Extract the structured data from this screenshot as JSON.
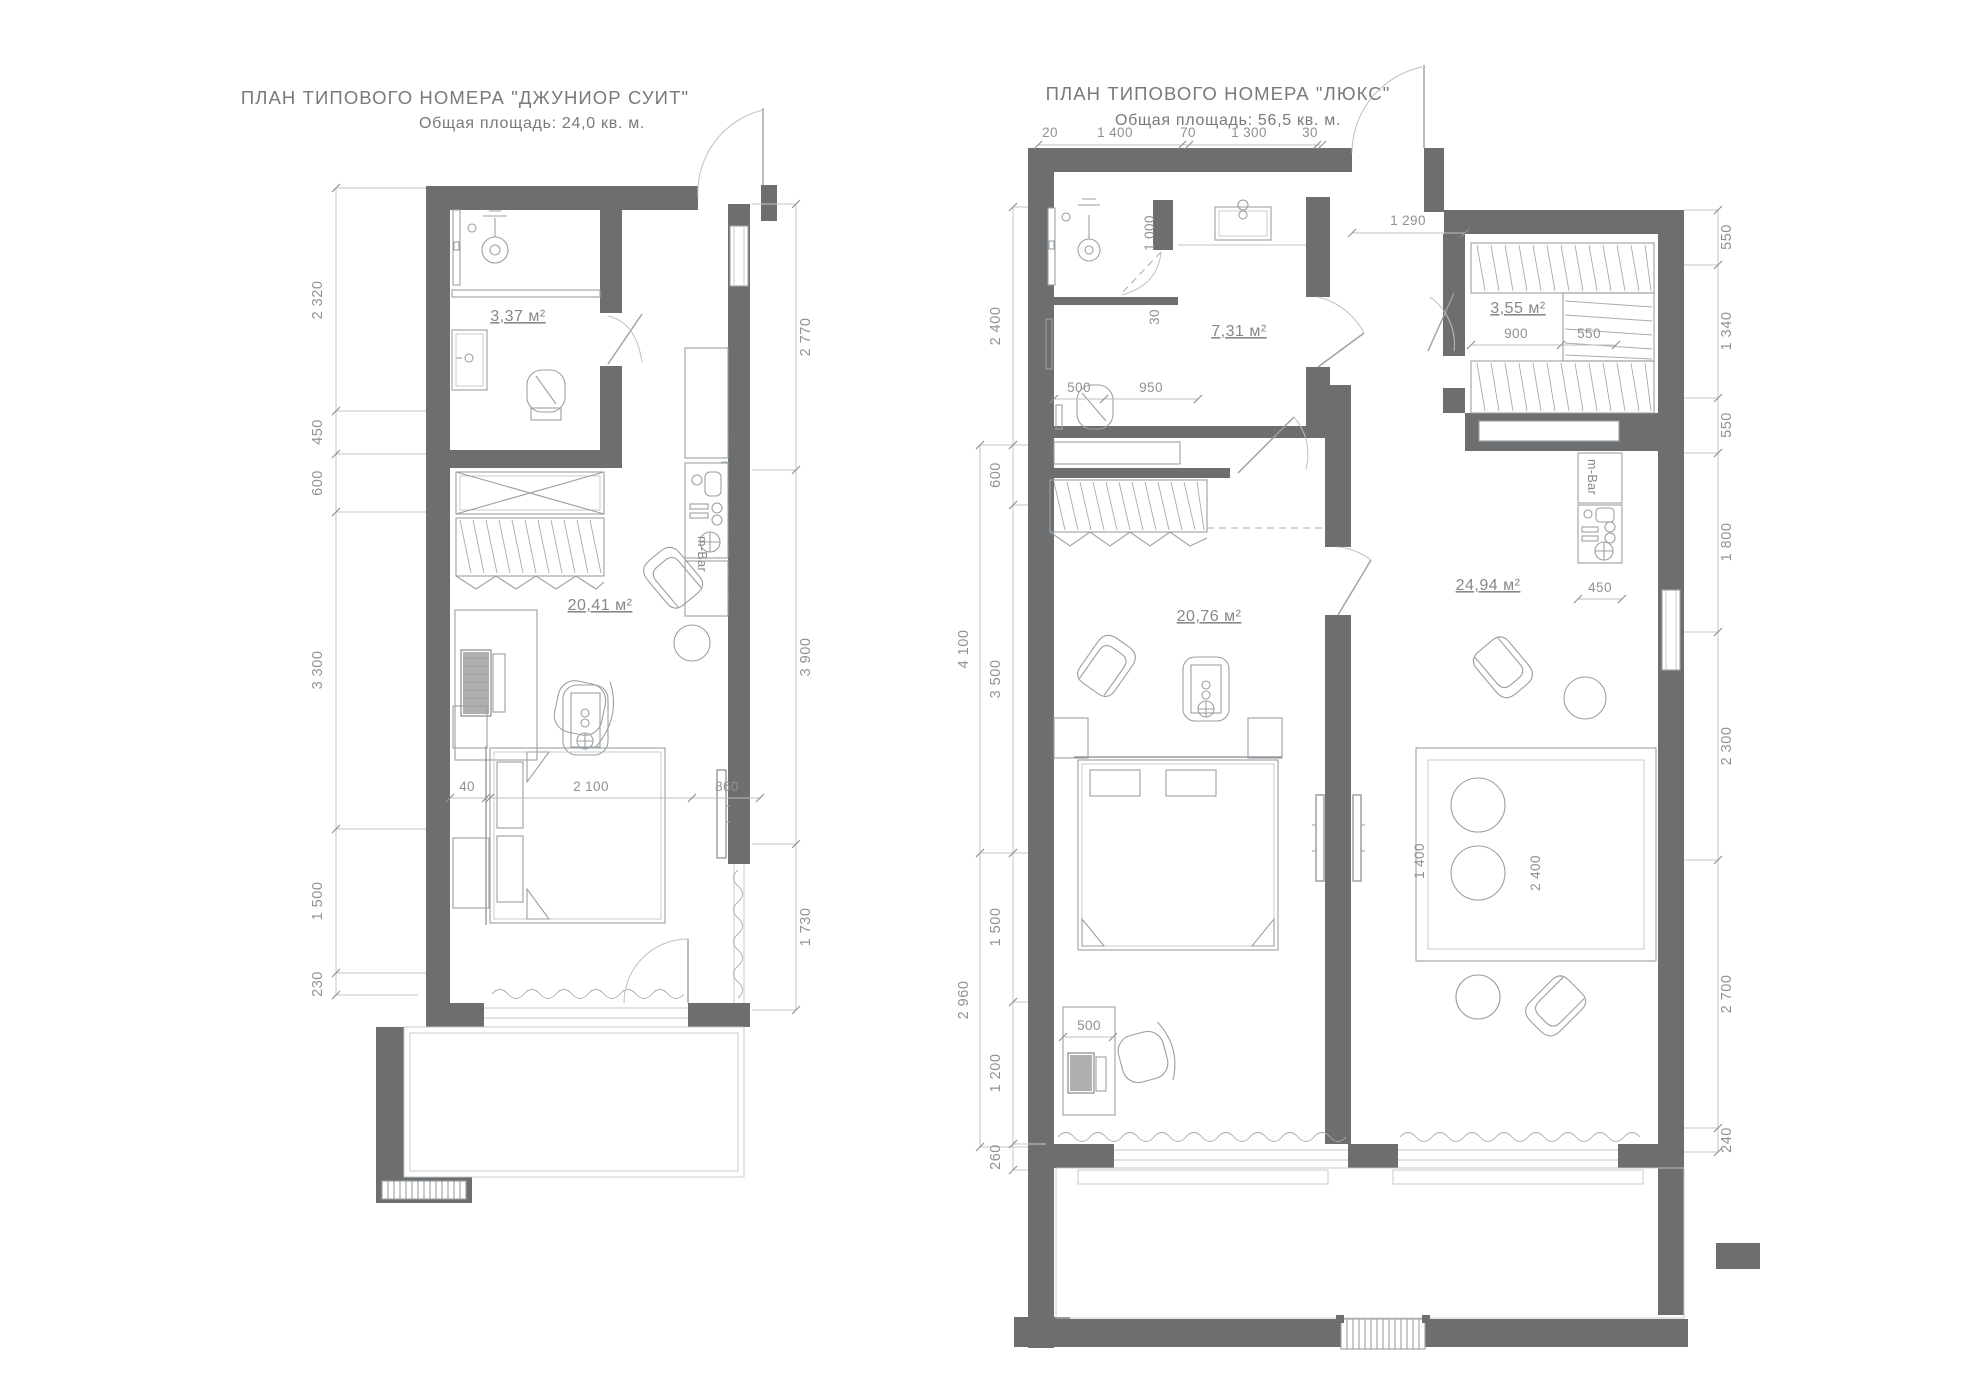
{
  "colors": {
    "wall": "#6d6e70",
    "furniture_line": "#9aa0a4",
    "dimension_line": "#bcbfc1",
    "text": "#8f9295",
    "background": "#ffffff"
  },
  "plans": [
    {
      "id": "junior-suite",
      "title": "ПЛАН  ТИПОВОГО НОМЕРА \"ДЖУНИОР СУИТ\"",
      "subtitle": "Общая площадь: 24,0 кв. м.",
      "areas": {
        "bath": "3,37 м²",
        "room": "20,41 м²"
      },
      "minibar": "m-Bar",
      "dims_left": [
        "2 320",
        "450",
        "600",
        "3 300",
        "1 500",
        "230"
      ],
      "dims_right": [
        "2 770",
        "3 900",
        "1 730"
      ],
      "dims_bed": [
        "40",
        "2 100",
        "860"
      ]
    },
    {
      "id": "lux",
      "title": "ПЛАН  ТИПОВОГО НОМЕРА \"ЛЮКС\"",
      "subtitle": "Общая площадь: 56,5 кв. м.",
      "areas": {
        "bath": "7,31 м²",
        "wardrobe": "3,55 м²",
        "bedroom": "20,76 м²",
        "living": "24,94 м²"
      },
      "minibar": "m-Bar",
      "dims_top": [
        "20",
        "1 400",
        "70",
        "1 300",
        "30"
      ],
      "dims_left": [
        "2 400",
        "600",
        "3 500",
        "1 500",
        "1 200",
        "260"
      ],
      "dims_left_outer": [
        "4 100",
        "2 960"
      ],
      "dims_right": [
        "550",
        "1 340",
        "550",
        "1 800",
        "2 300",
        "2 700",
        "240"
      ],
      "inner": {
        "vestibule": "1 290",
        "shower_width": "1 000",
        "shower_door": "30",
        "toilet_offset": "500",
        "toilet_span": "950",
        "wardrobe_width": "900",
        "wardrobe_depth": "550",
        "minibar_depth": "450",
        "desk_depth": "500",
        "sofa_width": "1 400",
        "sofa_length": "2 400"
      }
    }
  ]
}
